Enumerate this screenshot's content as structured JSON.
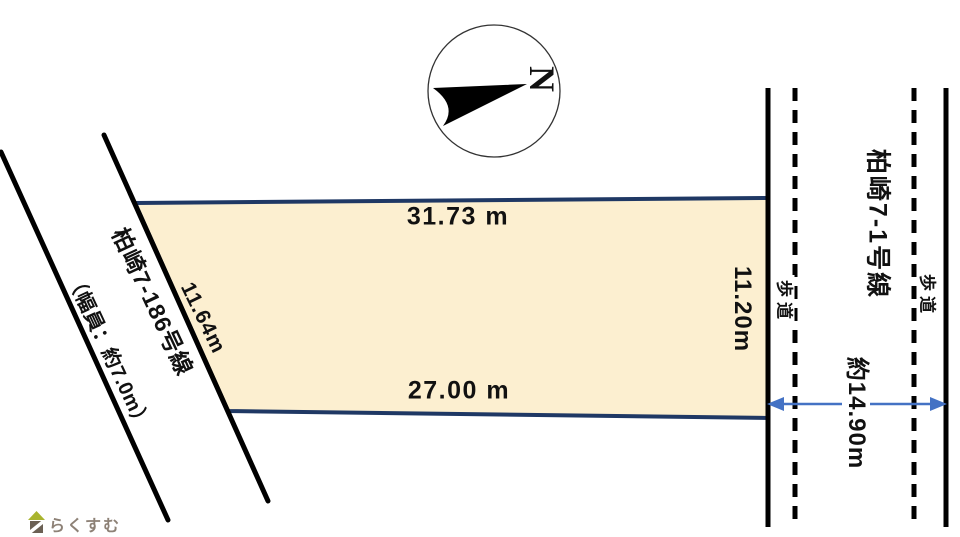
{
  "compass": {
    "label": "N"
  },
  "parcel": {
    "fill_color": "#fcefd0",
    "border_color": "#1f3864",
    "dim_top": "31.73 m",
    "dim_bottom": "27.00 m",
    "dim_left": "11.64m",
    "dim_right": "11.20m"
  },
  "left_road": {
    "name": "柏崎7-186号線",
    "width_note": "（幅員：約7.0m）",
    "line_color": "#000000"
  },
  "right_road": {
    "name": "柏崎7-1号線",
    "width_label": "約14.90m",
    "sidewalk_left": "歩道",
    "sidewalk_right": "歩道",
    "line_color": "#000000",
    "arrow_color": "#4472c4"
  },
  "logo": {
    "text": "らくすむ",
    "text_color": "#8d8176",
    "roof_color": "#a9b42e",
    "body_color": "#6b6054",
    "stripe_color": "#ffffff"
  }
}
